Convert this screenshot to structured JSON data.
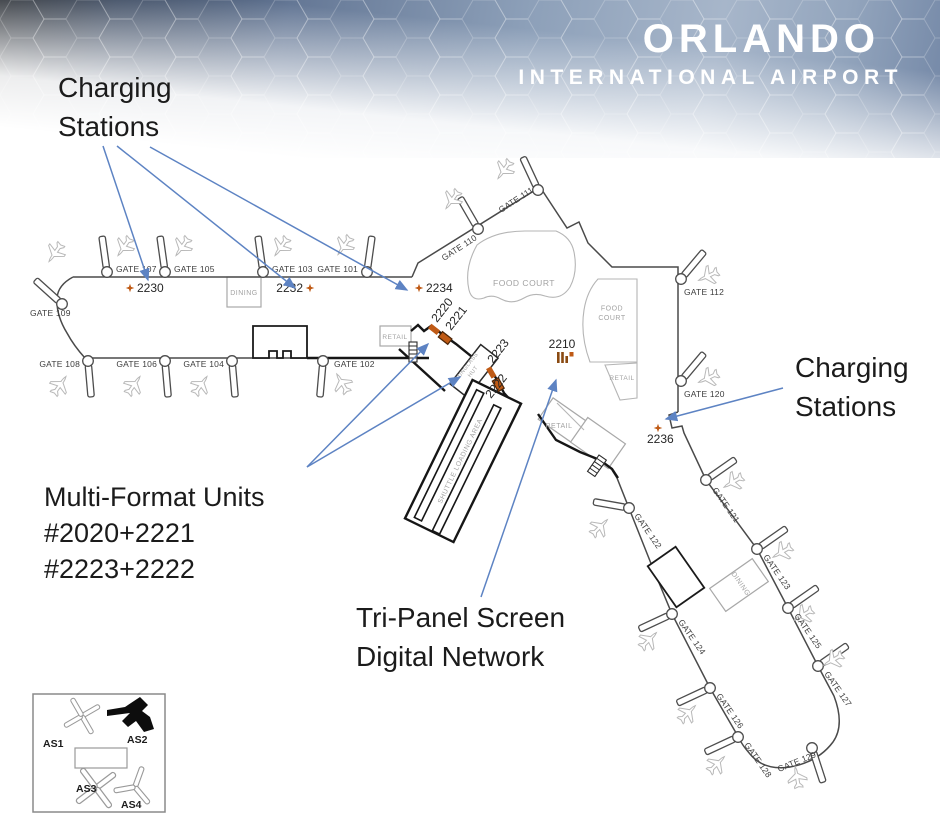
{
  "header": {
    "title": "ORLANDO",
    "subtitle": "INTERNATIONAL AIRPORT"
  },
  "annotations": {
    "charging_left": {
      "line1": "Charging",
      "line2": "Stations"
    },
    "charging_right": {
      "line1": "Charging",
      "line2": "Stations"
    },
    "multi_format": {
      "line1": "Multi-Format Units",
      "line2": "#2020+2221",
      "line3": "#2223+2222"
    },
    "tri_panel": {
      "line1": "Tri-Panel Screen",
      "line2": "Digital Network"
    }
  },
  "colors": {
    "arrow_blue": "#5d83c3",
    "marker_orange": "#bf5a15",
    "marker_brown": "#8a4a12"
  },
  "legend": {
    "items": [
      "AS1",
      "AS2",
      "AS3",
      "AS4"
    ]
  },
  "map": {
    "gates": [
      {
        "label": "GATE 107",
        "cx": 107,
        "cy": 272,
        "brot": -8,
        "lx": 116,
        "ly": 272,
        "lrot": 0,
        "anchor": "start",
        "px": 124,
        "py": 247,
        "prot": 215
      },
      {
        "label": "GATE 105",
        "cx": 165,
        "cy": 272,
        "brot": -8,
        "lx": 174,
        "ly": 272,
        "lrot": 0,
        "anchor": "start",
        "px": 182,
        "py": 247,
        "prot": 215
      },
      {
        "label": "GATE 103",
        "cx": 263,
        "cy": 272,
        "brot": -8,
        "lx": 272,
        "ly": 272,
        "lrot": 0,
        "anchor": "start",
        "px": 281,
        "py": 247,
        "prot": 215
      },
      {
        "label": "GATE 101",
        "cx": 367,
        "cy": 272,
        "brot": 8,
        "lx": 358,
        "ly": 272,
        "lrot": 0,
        "anchor": "end",
        "px": 344,
        "py": 246,
        "prot": 215
      },
      {
        "label": "GATE 109",
        "cx": 62,
        "cy": 304,
        "brot": -48,
        "lx": 30,
        "ly": 316,
        "lrot": 0,
        "anchor": "start",
        "px": 55,
        "py": 253,
        "prot": 215
      },
      {
        "label": "GATE 108",
        "cx": 88,
        "cy": 361,
        "brot": 175,
        "lx": 80,
        "ly": 367,
        "lrot": 0,
        "anchor": "end",
        "px": 60,
        "py": 385,
        "prot": 35
      },
      {
        "label": "GATE 106",
        "cx": 165,
        "cy": 361,
        "brot": 175,
        "lx": 157,
        "ly": 367,
        "lrot": 0,
        "anchor": "end",
        "px": 134,
        "py": 385,
        "prot": 35
      },
      {
        "label": "GATE 104",
        "cx": 232,
        "cy": 361,
        "brot": 175,
        "lx": 224,
        "ly": 367,
        "lrot": 0,
        "anchor": "end",
        "px": 201,
        "py": 385,
        "prot": 35
      },
      {
        "label": "GATE 102",
        "cx": 323,
        "cy": 361,
        "brot": 185,
        "lx": 334,
        "ly": 367,
        "lrot": 0,
        "anchor": "start",
        "px": 342,
        "py": 383,
        "prot": 330
      },
      {
        "label": "GATE 110",
        "cx": 478,
        "cy": 229,
        "brot": -30,
        "lx": 444,
        "ly": 261,
        "lrot": -33,
        "anchor": "start",
        "px": 452,
        "py": 200,
        "prot": 215
      },
      {
        "label": "GATE 111",
        "cx": 538,
        "cy": 190,
        "brot": -25,
        "lx": 501,
        "ly": 213,
        "lrot": -33,
        "anchor": "start",
        "px": 504,
        "py": 170,
        "prot": 215
      },
      {
        "label": "GATE 112",
        "cx": 681,
        "cy": 279,
        "brot": 40,
        "lx": 684,
        "ly": 295,
        "lrot": 0,
        "anchor": "start",
        "px": 708,
        "py": 276,
        "prot": 245
      },
      {
        "label": "GATE 120",
        "cx": 681,
        "cy": 381,
        "brot": 40,
        "lx": 684,
        "ly": 397,
        "lrot": 0,
        "anchor": "start",
        "px": 708,
        "py": 378,
        "prot": 245
      },
      {
        "label": "GATE 121",
        "cx": 706,
        "cy": 480,
        "brot": 55,
        "lx": 712,
        "ly": 490,
        "lrot": 55,
        "anchor": "start",
        "px": 733,
        "py": 482,
        "prot": 240
      },
      {
        "label": "GATE 123",
        "cx": 757,
        "cy": 549,
        "brot": 55,
        "lx": 763,
        "ly": 557,
        "lrot": 55,
        "anchor": "start",
        "px": 782,
        "py": 552,
        "prot": 240
      },
      {
        "label": "GATE 125",
        "cx": 788,
        "cy": 608,
        "brot": 55,
        "lx": 794,
        "ly": 616,
        "lrot": 55,
        "anchor": "start",
        "px": 803,
        "py": 615,
        "prot": 240
      },
      {
        "label": "GATE 127",
        "cx": 818,
        "cy": 666,
        "brot": 55,
        "lx": 824,
        "ly": 674,
        "lrot": 55,
        "anchor": "start",
        "px": 833,
        "py": 660,
        "prot": 240
      },
      {
        "label": "GATE 129",
        "cx": 812,
        "cy": 748,
        "brot": 162,
        "lx": 779,
        "ly": 772,
        "lrot": -22,
        "anchor": "start",
        "px": 797,
        "py": 777,
        "prot": 350
      },
      {
        "label": "GATE 122",
        "cx": 629,
        "cy": 508,
        "brot": 280,
        "lx": 634,
        "ly": 516,
        "lrot": 55,
        "anchor": "start",
        "px": 600,
        "py": 527,
        "prot": 45
      },
      {
        "label": "GATE 124",
        "cx": 672,
        "cy": 614,
        "brot": 245,
        "lx": 678,
        "ly": 622,
        "lrot": 55,
        "anchor": "start",
        "px": 649,
        "py": 640,
        "prot": 45
      },
      {
        "label": "GATE 126",
        "cx": 710,
        "cy": 688,
        "brot": 245,
        "lx": 716,
        "ly": 696,
        "lrot": 55,
        "anchor": "start",
        "px": 688,
        "py": 713,
        "prot": 45
      },
      {
        "label": "GATE 128",
        "cx": 738,
        "cy": 737,
        "brot": 245,
        "lx": 744,
        "ly": 745,
        "lrot": 55,
        "anchor": "start",
        "px": 717,
        "py": 764,
        "prot": 45
      }
    ],
    "charging_stations": [
      {
        "id": "2230",
        "star_x": 130,
        "star_y": 288,
        "label_x": 137,
        "label_y": 292,
        "anchor": "start"
      },
      {
        "id": "2232",
        "star_x": 310,
        "star_y": 288,
        "label_x": 303,
        "label_y": 292,
        "anchor": "end"
      },
      {
        "id": "2234",
        "star_x": 419,
        "star_y": 288,
        "label_x": 426,
        "label_y": 292,
        "anchor": "start"
      },
      {
        "id": "2236",
        "star_x": 658,
        "star_y": 428,
        "label_x": 647,
        "label_y": 443,
        "anchor": "start"
      }
    ],
    "mfu_marker_pairs": [
      {
        "cx": 440,
        "cy": 334,
        "rot": 38
      },
      {
        "cx": 495,
        "cy": 379,
        "rot": 60
      }
    ],
    "mfu_labels": [
      {
        "text": "2220",
        "x": 437,
        "y": 323
      },
      {
        "text": "2221",
        "x": 451,
        "y": 331
      },
      {
        "text": "2223",
        "x": 493,
        "y": 364
      },
      {
        "text": "2222",
        "x": 491,
        "y": 399
      }
    ],
    "tri_panel": {
      "id": "2210",
      "label_x": 562,
      "label_y": 348,
      "icon_x": 557,
      "icon_y": 352
    },
    "areas": [
      {
        "lines": [
          "DINING"
        ],
        "x": 244,
        "y": 295,
        "rot": 0,
        "size": 7
      },
      {
        "lines": [
          "RETAIL"
        ],
        "x": 395,
        "y": 339,
        "rot": 0,
        "size": 6.5
      },
      {
        "lines": [
          "FOOD COURT"
        ],
        "x": 524,
        "y": 286,
        "rot": 0,
        "size": 8.5
      },
      {
        "lines": [
          "FOOD",
          "COURT"
        ],
        "x": 612,
        "y": 315,
        "rot": 0,
        "size": 7
      },
      {
        "lines": [
          "RETAIL"
        ],
        "x": 622,
        "y": 380,
        "rot": 0,
        "size": 6.5
      },
      {
        "lines": [
          "RETAIL"
        ],
        "x": 559,
        "y": 428,
        "rot": 0,
        "size": 7
      },
      {
        "lines": [
          "SUNGLASS",
          "HUT"
        ],
        "x": 471,
        "y": 370,
        "rot": -52,
        "size": 5.5
      },
      {
        "lines": [
          "SHUTTLE LOADING AREA"
        ],
        "x": 462,
        "y": 462,
        "rot": -64,
        "size": 6.8
      },
      {
        "lines": [
          "DINING"
        ],
        "x": 739,
        "y": 585,
        "rot": 55,
        "size": 7
      }
    ],
    "arrows": [
      {
        "x1": 103,
        "y1": 146,
        "x2": 148,
        "y2": 280
      },
      {
        "x1": 117,
        "y1": 146,
        "x2": 295,
        "y2": 288
      },
      {
        "x1": 150,
        "y1": 147,
        "x2": 407,
        "y2": 290
      },
      {
        "x1": 783,
        "y1": 388,
        "x2": 666,
        "y2": 419
      },
      {
        "x1": 307,
        "y1": 467,
        "x2": 428,
        "y2": 344
      },
      {
        "x1": 307,
        "y1": 467,
        "x2": 460,
        "y2": 377
      },
      {
        "x1": 481,
        "y1": 597,
        "x2": 556,
        "y2": 380
      }
    ]
  }
}
